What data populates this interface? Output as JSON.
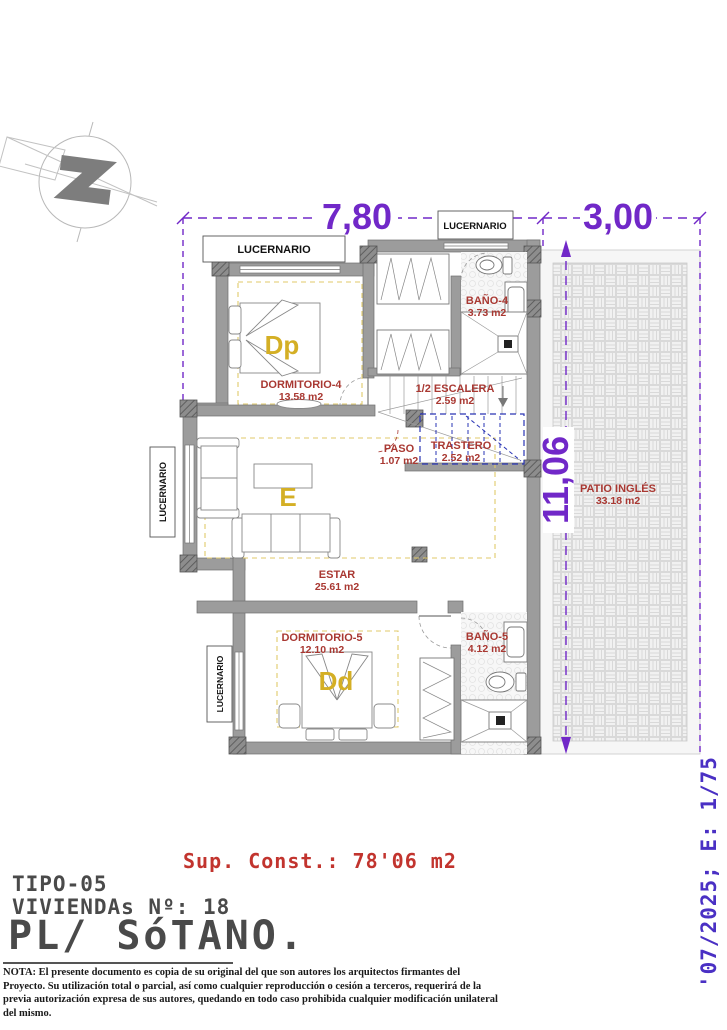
{
  "dimensions": {
    "top_main": "7,80",
    "top_patio": "3,00",
    "side_height": "11,06"
  },
  "labels": {
    "lucernario": "LUCERNARIO"
  },
  "rooms": {
    "dormitorio4": {
      "name": "DORMITORIO-4",
      "area": "13.58 m2",
      "letter": "Dp"
    },
    "bano4": {
      "name": "BAÑO-4",
      "area": "3.73 m2"
    },
    "escalera": {
      "name": "1/2 ESCALERA",
      "area": "2.59 m2"
    },
    "paso": {
      "name": "PASO",
      "area": "1.07 m2"
    },
    "trastero": {
      "name": "TRASTERO",
      "area": "2.52 m2"
    },
    "estar": {
      "name": "ESTAR",
      "area": "25.61 m2",
      "letter": "E"
    },
    "dormitorio5": {
      "name": "DORMITORIO-5",
      "area": "12.10 m2",
      "letter": "Dd"
    },
    "bano5": {
      "name": "BAÑO-5",
      "area": "4.12 m2"
    },
    "patio": {
      "name": "PATIO INGLÉS",
      "area": "33.18 m2"
    }
  },
  "title_block": {
    "sup_const": "Sup. Const.: 78'06 m2",
    "tipo": "TIPO-05",
    "viviendas": "VIVIENDAs Nº: 18",
    "planta": "PL/ SóTANO."
  },
  "side_text": "'07/2025; E: 1/75",
  "note": "NOTA: El presente documento es copia de su original del que son autores los arquitectos firmantes del Proyecto. Su utilización total o parcial, así como cualquier reproducción o cesión a terceros, requerirá de la previa autorización expresa de sus autores, quedando en todo caso prohibida cualquier modificación unilateral del mismo.",
  "colors": {
    "dimension_purple": "#7128c8",
    "scale_purple": "#4a30c4",
    "label_red": "#a93832",
    "letter_yellow": "#d4af25",
    "trastero_blue": "#2a35b5",
    "wall_gray": "#9c9c9c",
    "sup_const_red": "#c2342e",
    "title_gray": "#4a4a4a"
  }
}
